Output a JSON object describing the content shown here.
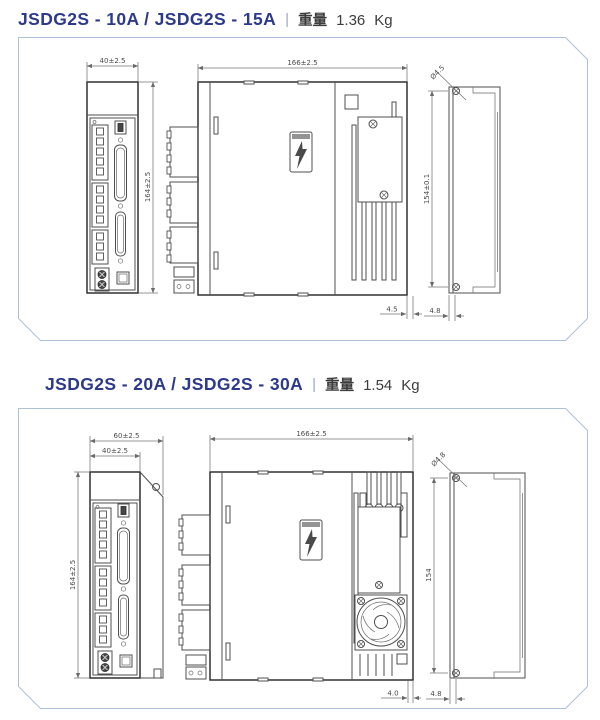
{
  "page": {
    "background": "#ffffff",
    "panel_border_color": "#aebfd8",
    "drawing_line_color": "#4f4f4f",
    "title_color": "#2d3a8c"
  },
  "glyphs": {
    "warning_label": "lightning-bolt-icon",
    "mounting_hole": "phillips-screw-icon",
    "fan": "cooling-fan-icon"
  },
  "sections": [
    {
      "title": {
        "model": "JSDG2S - 10A / JSDG2S - 15A",
        "separator": "|",
        "weight_label": "重量",
        "weight_value": "1.36",
        "weight_unit": "Kg"
      },
      "front_view": {
        "width": "40±2.5",
        "height": "164±2.5"
      },
      "side_view": {
        "width": "166±2.5",
        "gap": "4.5"
      },
      "rear_view": {
        "hole": "Ø4.5",
        "pitch": "154±0.1",
        "thickness": "4.8"
      }
    },
    {
      "title": {
        "model": "JSDG2S - 20A / JSDG2S - 30A",
        "separator": "|",
        "weight_label": "重量",
        "weight_value": "1.54",
        "weight_unit": "Kg"
      },
      "front_view": {
        "outer_width": "60±2.5",
        "width": "40±2.5",
        "height": "164±2.5"
      },
      "side_view": {
        "width": "166±2.5",
        "gap": "4.0"
      },
      "rear_view": {
        "hole": "Ø4.8",
        "pitch": "154",
        "thickness": "4.8"
      }
    }
  ]
}
